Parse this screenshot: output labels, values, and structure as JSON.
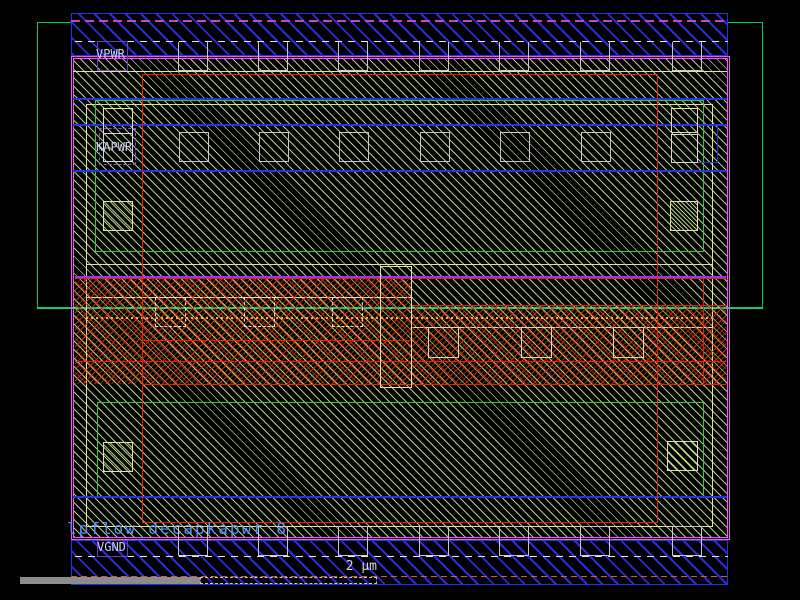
{
  "viewer": {
    "type": "vlsi-layout-viewer",
    "scale_label": "2 µm",
    "background": "#000000"
  },
  "labels": {
    "power_rail": "VPWR",
    "keepalive_power": "KAPWR",
    "ground_rail": "VGND",
    "cell_name": "lpflow_decapkapwr_8"
  },
  "colors": {
    "metal_blue": "#2233ee",
    "cell_boundary_magenta": "#ff4dff",
    "nwell_green": "#00cc66",
    "diffusion_green": "#33cc33",
    "substrate_hatch": "#d0f296",
    "poly_red": "#e62200",
    "implant_orange": "#ffaa33",
    "tap_khaki": "#e6dfa0",
    "contact_gray": "#c8c8c8",
    "label_purple": "#6a3ccc",
    "label_text": "#ccd2f0",
    "cell_name_text": "#4d94ff",
    "ruler_red": "#e05540",
    "scalebar_gray": "#8c8c8c"
  },
  "repeat_boxes": {
    "top_edge_contacts": {
      "xs": [
        178,
        258,
        338,
        419,
        499,
        580,
        672
      ],
      "y": 42,
      "w": 30,
      "h": 29,
      "style": "contact-solid"
    },
    "bottom_edge_contacts": {
      "xs": [
        178,
        258,
        338,
        419,
        499,
        580,
        672
      ],
      "y": 526,
      "w": 30,
      "h": 30,
      "style": "contact-gray"
    },
    "upper_row_contacts": {
      "xs": [
        179,
        259,
        339,
        420,
        500,
        581
      ],
      "y": 132,
      "w": 30,
      "h": 30,
      "style": "contact-gray"
    },
    "mid_left_contacts": {
      "xs": [
        155,
        244,
        332
      ],
      "y": 297,
      "w": 31,
      "h": 30,
      "style": "contact-dashed"
    },
    "mid_right_contacts": {
      "xs": [
        428,
        521,
        613
      ],
      "y": 327,
      "w": 31,
      "h": 31,
      "style": "contact-cream"
    }
  }
}
